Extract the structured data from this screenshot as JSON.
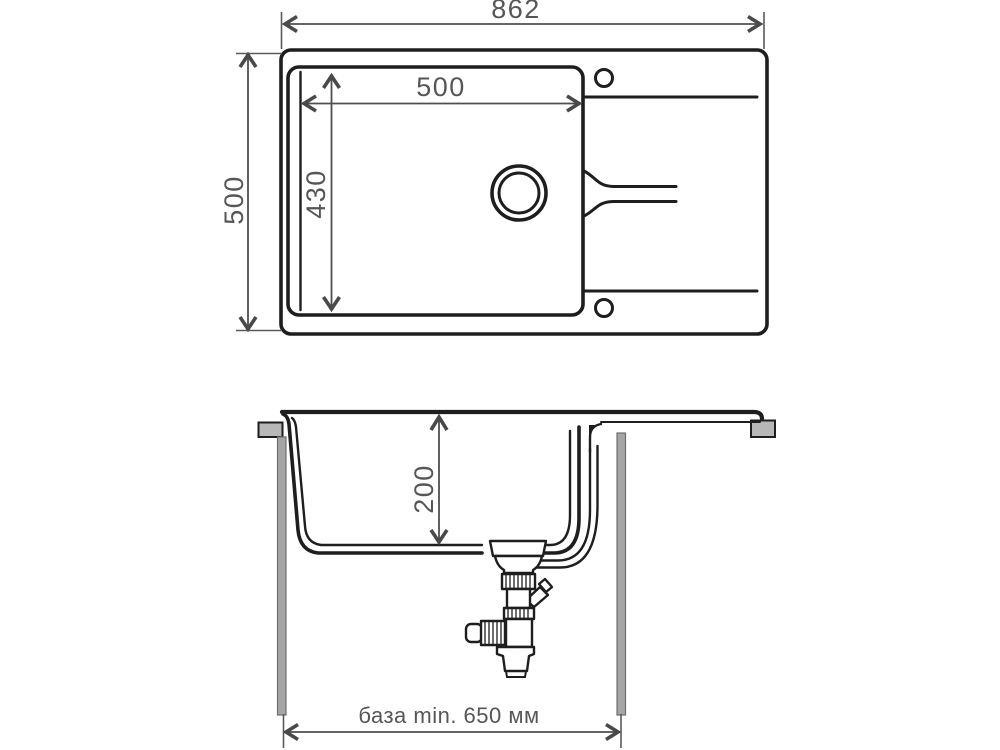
{
  "drawing": {
    "type": "technical-dimension-drawing",
    "subject": "kitchen-sink",
    "plan": {
      "dim_overall_width": "862",
      "dim_overall_depth": "500",
      "dim_bowl_width": "500",
      "dim_bowl_depth": "430"
    },
    "section": {
      "dim_bowl_height": "200",
      "dim_base_cabinet": "база min. 650 мм"
    },
    "colors": {
      "outline": "#1e1e1e",
      "dimension": "#4f4f4f",
      "dimension_text": "#565658",
      "bracket_fill": "#b7b7b7",
      "cabinet_panel_fill": "#a5a5a5",
      "background": "#ffffff"
    }
  }
}
